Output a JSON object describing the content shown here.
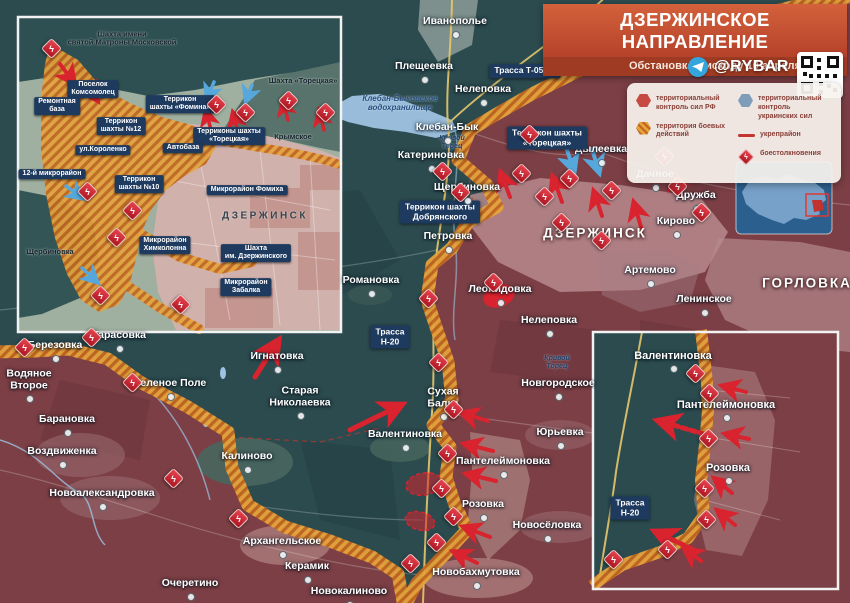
{
  "header": {
    "title": "ДЗЕРЖИНСКОЕ НАПРАВЛЕНИЕ",
    "subtitle": "Обстановка к исходу 10 апреля 2025 г.",
    "handle": "@RYBAR"
  },
  "legend": {
    "items": [
      {
        "icon": "hex-red",
        "label": "территориальный контроль сил РФ"
      },
      {
        "icon": "hex-hatch",
        "label": "территория боевых действий"
      },
      {
        "icon": "hex-blue",
        "label": "территориальный контроль украинских сил"
      },
      {
        "icon": "line-red",
        "label": "укрепрайон"
      },
      {
        "icon": "diamond-clash",
        "label": "боестолкновения"
      }
    ]
  },
  "colors": {
    "ua_teal": "#2c4b4f",
    "ru_red": "#7b3f45",
    "combat_hatch_orange": "#e5a33c",
    "clash_red": "#d9232e",
    "arrow_blue": "#56a8dc",
    "label_box_navy": "#1e3a5f"
  },
  "map": {
    "labels": [
      {
        "t": "Иванополье",
        "x": 455,
        "y": 22,
        "k": "t"
      },
      {
        "t": "Плещеевка",
        "x": 424,
        "y": 67,
        "k": "t"
      },
      {
        "t": "Нелеповка",
        "x": 483,
        "y": 90,
        "k": "t"
      },
      {
        "t": "Клебан-Бык",
        "x": 447,
        "y": 128,
        "k": "t"
      },
      {
        "t": "Катериновка",
        "x": 431,
        "y": 156,
        "k": "t"
      },
      {
        "t": "Щербиновка",
        "x": 467,
        "y": 188,
        "k": "t"
      },
      {
        "t": "Петровка",
        "x": 448,
        "y": 237,
        "k": "t"
      },
      {
        "t": "Романовка",
        "x": 371,
        "y": 281,
        "k": "t"
      },
      {
        "t": "Леонидовка",
        "x": 500,
        "y": 290,
        "k": "t"
      },
      {
        "t": "Нелеповка",
        "x": 549,
        "y": 321,
        "k": "t"
      },
      {
        "t": "Дылеевка",
        "x": 601,
        "y": 150,
        "k": "t"
      },
      {
        "t": "Дачное",
        "x": 655,
        "y": 175,
        "k": "t"
      },
      {
        "t": "Дружба",
        "x": 696,
        "y": 196,
        "k": "t"
      },
      {
        "t": "Кирово",
        "x": 676,
        "y": 222,
        "k": "t"
      },
      {
        "t": "Артемово",
        "x": 650,
        "y": 271,
        "k": "t"
      },
      {
        "t": "Ленинское",
        "x": 704,
        "y": 300,
        "k": "t"
      },
      {
        "t": "Тарасовка",
        "x": 119,
        "y": 336,
        "k": "t"
      },
      {
        "t": "Березовка",
        "x": 55,
        "y": 346,
        "k": "t"
      },
      {
        "t": "Водяное\nВторое",
        "x": 29,
        "y": 380,
        "k": "t"
      },
      {
        "t": "Зеленое Поле",
        "x": 170,
        "y": 384,
        "k": "t"
      },
      {
        "t": "Барановка",
        "x": 67,
        "y": 420,
        "k": "t"
      },
      {
        "t": "Воздвиженка",
        "x": 62,
        "y": 452,
        "k": "t"
      },
      {
        "t": "Новоалександровка",
        "x": 102,
        "y": 494,
        "k": "t"
      },
      {
        "t": "Очеретино",
        "x": 190,
        "y": 584,
        "k": "t"
      },
      {
        "t": "Калиново",
        "x": 247,
        "y": 457,
        "k": "t"
      },
      {
        "t": "Игнатовка",
        "x": 277,
        "y": 357,
        "k": "t"
      },
      {
        "t": "Старая\nНиколаевка",
        "x": 300,
        "y": 397,
        "k": "t"
      },
      {
        "t": "Валентиновка",
        "x": 405,
        "y": 435,
        "k": "t"
      },
      {
        "t": "Сухая\nБалка",
        "x": 443,
        "y": 398,
        "k": "t"
      },
      {
        "t": "Пантелеймоновка",
        "x": 503,
        "y": 462,
        "k": "t"
      },
      {
        "t": "Розовка",
        "x": 483,
        "y": 505,
        "k": "t"
      },
      {
        "t": "Юрьевка",
        "x": 560,
        "y": 433,
        "k": "t"
      },
      {
        "t": "Новгородское",
        "x": 558,
        "y": 384,
        "k": "t"
      },
      {
        "t": "Новосёловка",
        "x": 547,
        "y": 526,
        "k": "t"
      },
      {
        "t": "Новобахмутовка",
        "x": 476,
        "y": 573,
        "k": "t"
      },
      {
        "t": "Архангельское",
        "x": 282,
        "y": 542,
        "k": "t"
      },
      {
        "t": "Керамик",
        "x": 307,
        "y": 567,
        "k": "t"
      },
      {
        "t": "Новокалиново",
        "x": 349,
        "y": 592,
        "k": "t"
      },
      {
        "t": "ДЗЕРЖИНСК",
        "x": 595,
        "y": 233,
        "k": "c"
      },
      {
        "t": "ГОРЛОВКА",
        "x": 807,
        "y": 283,
        "k": "c"
      },
      {
        "t": "Трасса Т-05-16",
        "x": 525,
        "y": 71,
        "k": "b"
      },
      {
        "t": "Террикон шахты\n«Торецкая»",
        "x": 547,
        "y": 138,
        "k": "b"
      },
      {
        "t": "Террикон шахты\nДобрянского",
        "x": 440,
        "y": 212,
        "k": "b"
      },
      {
        "t": "Трасса\nН-20",
        "x": 390,
        "y": 337,
        "k": "b"
      },
      {
        "t": "Трасса\nН-20",
        "x": 630,
        "y": 508,
        "k": "b"
      },
      {
        "t": "Клебан-Быковское\nводохранилище",
        "x": 400,
        "y": 104,
        "k": "w"
      },
      {
        "t": "Кривой\nТорец",
        "x": 452,
        "y": 143,
        "k": "w2"
      },
      {
        "t": "Кривой\nТорец",
        "x": 557,
        "y": 363,
        "k": "w2"
      },
      {
        "t": "Шахта имени\nсвятой Матроны Московской",
        "x": 122,
        "y": 39,
        "k": "id"
      },
      {
        "t": "Шахта «Торецкая»",
        "x": 303,
        "y": 81,
        "k": "id"
      },
      {
        "t": "Крымское",
        "x": 293,
        "y": 137,
        "k": "id"
      },
      {
        "t": "Щербиновка",
        "x": 50,
        "y": 252,
        "k": "id"
      },
      {
        "t": "ДЗЕРЖИНСК",
        "x": 265,
        "y": 216,
        "k": "ic"
      },
      {
        "t": "Поселок\nКомсомолец",
        "x": 93,
        "y": 89,
        "k": "ib"
      },
      {
        "t": "Ремонтная\nбаза",
        "x": 57,
        "y": 106,
        "k": "ib"
      },
      {
        "t": "Террикон\nшахты №12",
        "x": 121,
        "y": 126,
        "k": "ib"
      },
      {
        "t": "ул.Короленко",
        "x": 103,
        "y": 150,
        "k": "ib"
      },
      {
        "t": "12-й микрорайон",
        "x": 52,
        "y": 174,
        "k": "ib"
      },
      {
        "t": "Террикон\nшахты №10",
        "x": 139,
        "y": 184,
        "k": "ib"
      },
      {
        "t": "Террикон\nшахты «Фомина»",
        "x": 180,
        "y": 104,
        "k": "ib"
      },
      {
        "t": "Терриконы шахты\n«Торецкая»",
        "x": 229,
        "y": 136,
        "k": "ib"
      },
      {
        "t": "Автобаза",
        "x": 183,
        "y": 148,
        "k": "ib"
      },
      {
        "t": "Микрорайон Фомиха",
        "x": 247,
        "y": 190,
        "k": "ib"
      },
      {
        "t": "Микрорайон\nХимколонна",
        "x": 165,
        "y": 245,
        "k": "ib"
      },
      {
        "t": "Шахта\nим. Дзержинского",
        "x": 256,
        "y": 253,
        "k": "ib"
      },
      {
        "t": "Микрорайон\nЗабалка",
        "x": 246,
        "y": 287,
        "k": "ib"
      },
      {
        "t": "Валентиновка",
        "x": 673,
        "y": 356,
        "k": "st"
      },
      {
        "t": "Пантелеймоновка",
        "x": 726,
        "y": 405,
        "k": "st"
      },
      {
        "t": "Розовка",
        "x": 728,
        "y": 468,
        "k": "st"
      }
    ],
    "clashes": [
      [
        528,
        133
      ],
      [
        441,
        170
      ],
      [
        459,
        191
      ],
      [
        520,
        172
      ],
      [
        543,
        195
      ],
      [
        568,
        177
      ],
      [
        610,
        189
      ],
      [
        663,
        155
      ],
      [
        676,
        185
      ],
      [
        700,
        211
      ],
      [
        560,
        221
      ],
      [
        600,
        239
      ],
      [
        492,
        281
      ],
      [
        427,
        297
      ],
      [
        437,
        361
      ],
      [
        452,
        408
      ],
      [
        446,
        452
      ],
      [
        440,
        487
      ],
      [
        452,
        515
      ],
      [
        435,
        541
      ],
      [
        409,
        562
      ],
      [
        23,
        346
      ],
      [
        90,
        336
      ],
      [
        131,
        381
      ],
      [
        172,
        477
      ],
      [
        237,
        517
      ],
      [
        50,
        47
      ],
      [
        215,
        103
      ],
      [
        244,
        111
      ],
      [
        287,
        99
      ],
      [
        324,
        111
      ],
      [
        86,
        190
      ],
      [
        131,
        209
      ],
      [
        115,
        236
      ],
      [
        99,
        294
      ],
      [
        179,
        303
      ],
      [
        694,
        372
      ],
      [
        708,
        392
      ],
      [
        707,
        437
      ],
      [
        703,
        487
      ],
      [
        705,
        518
      ],
      [
        666,
        548
      ],
      [
        612,
        558
      ]
    ],
    "arrows": [
      {
        "p": [
          255,
          377,
          278,
          341
        ],
        "c": "r",
        "w": 5
      },
      {
        "p": [
          350,
          430,
          401,
          405
        ],
        "c": "r",
        "w": 5
      },
      {
        "p": [
          510,
          197,
          501,
          173
        ],
        "c": "r",
        "w": 4
      },
      {
        "p": [
          562,
          202,
          553,
          177
        ],
        "c": "r",
        "w": 4
      },
      {
        "p": [
          602,
          216,
          594,
          192
        ],
        "c": "r",
        "w": 4
      },
      {
        "p": [
          641,
          227,
          634,
          203
        ],
        "c": "r",
        "w": 4
      },
      {
        "p": [
          681,
          197,
          673,
          173
        ],
        "c": "r",
        "w": 4
      },
      {
        "p": [
          488,
          421,
          462,
          413
        ],
        "c": "r",
        "w": 4
      },
      {
        "p": [
          493,
          451,
          465,
          444
        ],
        "c": "r",
        "w": 4
      },
      {
        "p": [
          496,
          481,
          467,
          474
        ],
        "c": "r",
        "w": 4
      },
      {
        "p": [
          490,
          537,
          464,
          527
        ],
        "c": "r",
        "w": 4
      },
      {
        "p": [
          477,
          563,
          454,
          552
        ],
        "c": "r",
        "w": 4
      },
      {
        "p": [
          566,
          147,
          574,
          171
        ],
        "c": "b",
        "w": 4
      },
      {
        "p": [
          592,
          149,
          599,
          172
        ],
        "c": "b",
        "w": 4
      },
      {
        "p": [
          60,
          64,
          74,
          83
        ],
        "c": "r",
        "w": 4
      },
      {
        "p": [
          86,
          84,
          97,
          100
        ],
        "c": "r",
        "w": 4
      },
      {
        "p": [
          211,
          130,
          206,
          111
        ],
        "c": "r",
        "w": 3.5
      },
      {
        "p": [
          238,
          132,
          233,
          113
        ],
        "c": "r",
        "w": 3.5
      },
      {
        "p": [
          288,
          120,
          283,
          101
        ],
        "c": "r",
        "w": 3.5
      },
      {
        "p": [
          324,
          130,
          319,
          111
        ],
        "c": "r",
        "w": 3.5
      },
      {
        "p": [
          214,
          82,
          207,
          99
        ],
        "c": "b",
        "w": 3.5
      },
      {
        "p": [
          252,
          85,
          246,
          101
        ],
        "c": "b",
        "w": 3.5
      },
      {
        "p": [
          66,
          186,
          82,
          198
        ],
        "c": "b",
        "w": 3.5
      },
      {
        "p": [
          82,
          268,
          97,
          282
        ],
        "c": "b",
        "w": 3.5
      },
      {
        "p": [
          746,
          392,
          723,
          386
        ],
        "c": "r",
        "w": 4
      },
      {
        "p": [
          749,
          439,
          726,
          434
        ],
        "c": "r",
        "w": 4
      },
      {
        "p": [
          732,
          493,
          715,
          479
        ],
        "c": "r",
        "w": 4
      },
      {
        "p": [
          735,
          525,
          718,
          511
        ],
        "c": "r",
        "w": 4
      },
      {
        "p": [
          701,
          561,
          685,
          549
        ],
        "c": "r",
        "w": 4
      },
      {
        "p": [
          704,
          434,
          659,
          421
        ],
        "c": "r",
        "w": 5,
        "d": 1
      },
      {
        "p": [
          692,
          549,
          656,
          532
        ],
        "c": "r",
        "w": 5,
        "d": 1
      }
    ],
    "blobs": [
      {
        "cx": 499,
        "cy": 296,
        "rx": 16,
        "ry": 11,
        "rot": -20,
        "solid": 1
      },
      {
        "cx": 424,
        "cy": 484,
        "rx": 18,
        "ry": 11,
        "rot": -10
      },
      {
        "cx": 420,
        "cy": 521,
        "rx": 15,
        "ry": 9,
        "rot": 15
      }
    ]
  }
}
